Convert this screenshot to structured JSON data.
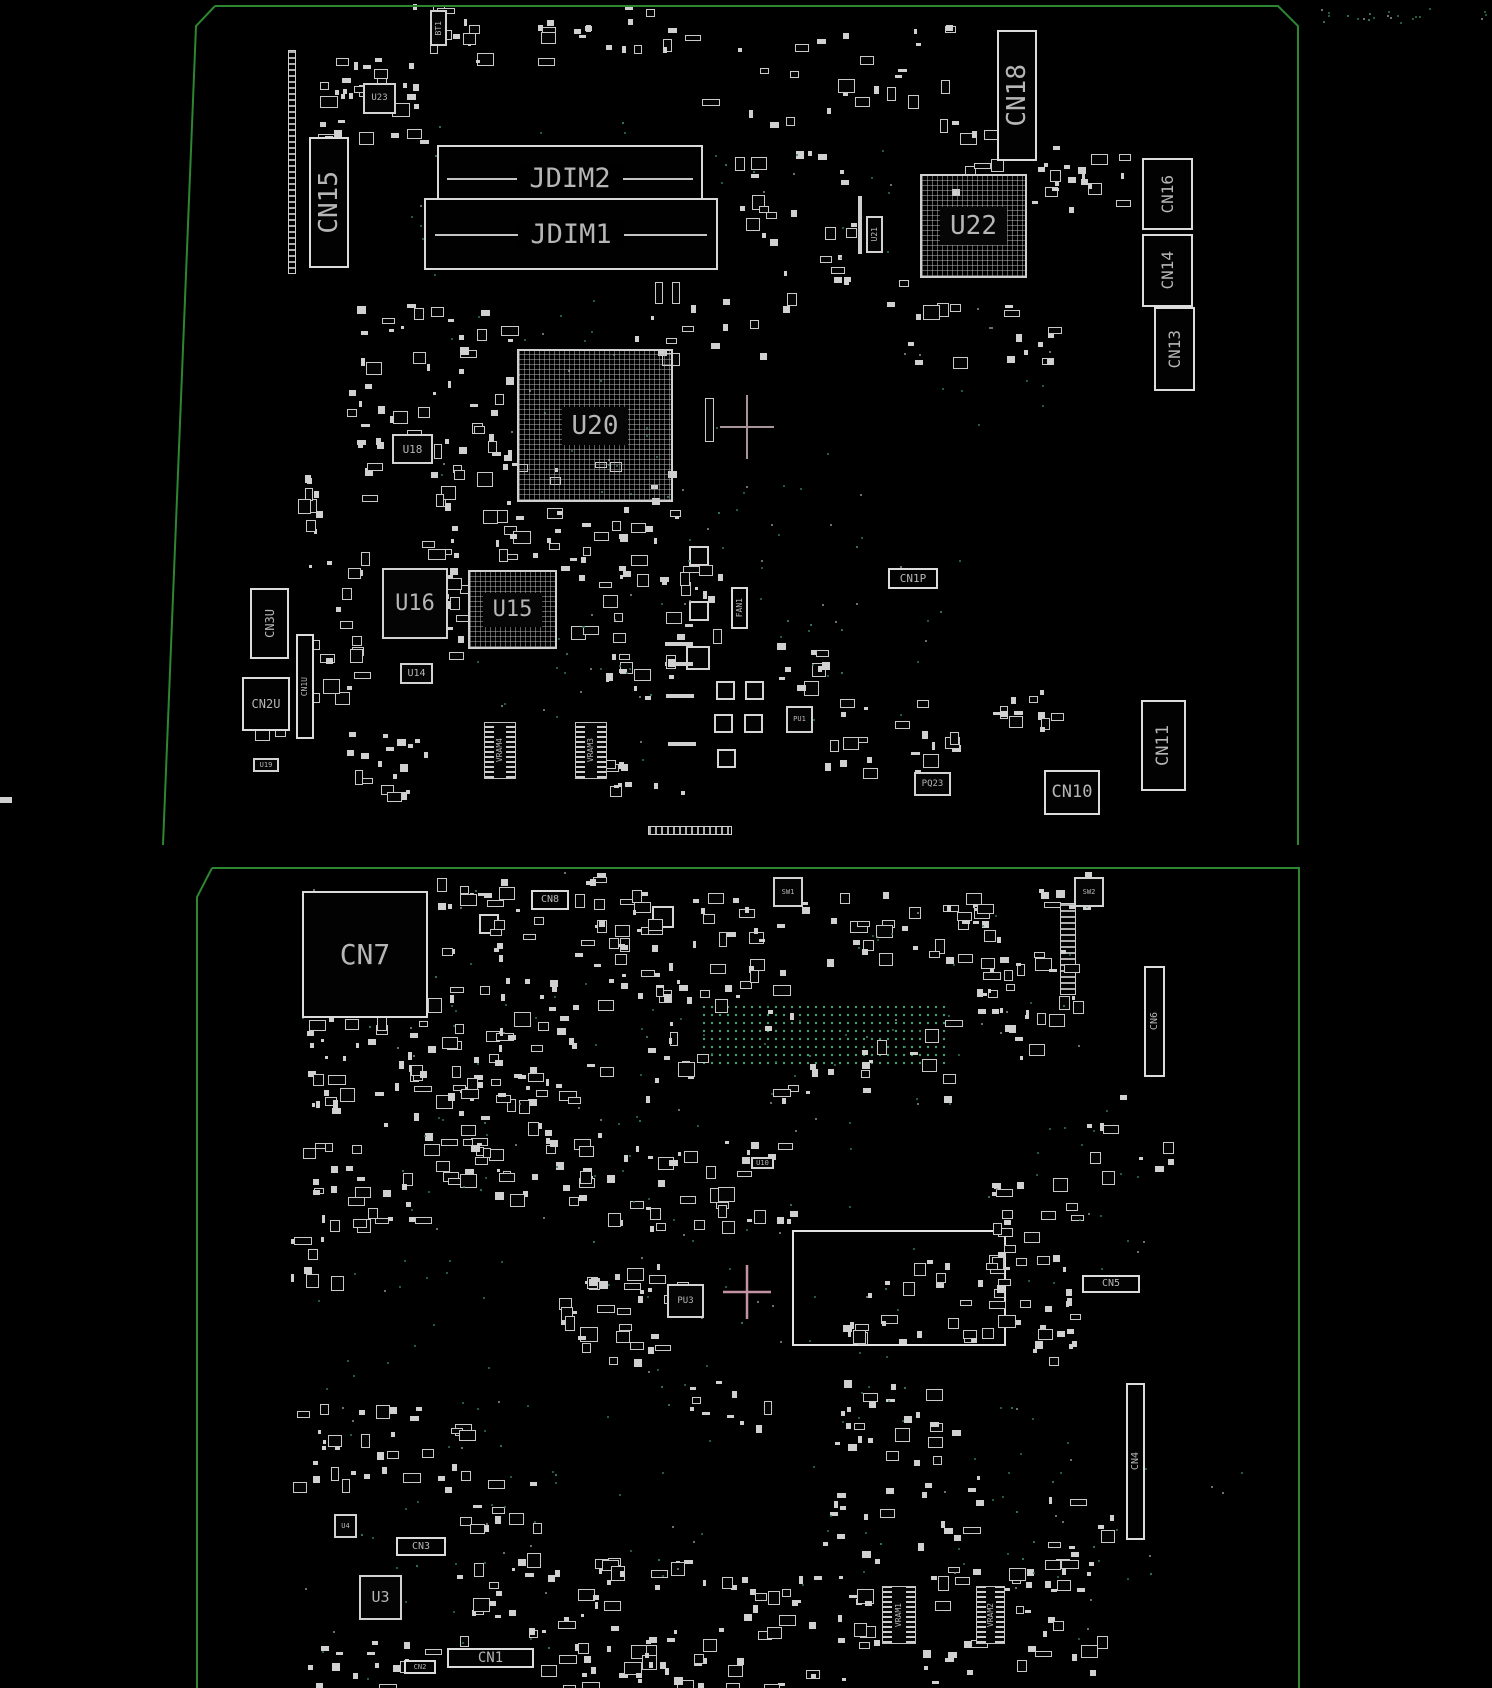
{
  "meta": {
    "description": "PCB boardview silkscreen diagram, two board sides on black background",
    "colors": {
      "background": "#000000",
      "board_outline": "#2d8632",
      "silkscreen": "#d6d6d6",
      "label_text": "#b6b6b6",
      "via_dot_green": "#2f7a50",
      "crosshair_top": "#a89399",
      "crosshair_bottom": "#c493a3"
    }
  },
  "boards": [
    {
      "name": "top-board",
      "outline_path": "M215,6 L1278,6 L1298,26 L1298,845 M215,6 L196,26 L163,845"
    },
    {
      "name": "bottom-board",
      "outline_path": "M212,868 L1299,868 L1299,1688 M212,868 L197,897 L197,1688"
    }
  ],
  "components": [
    {
      "l": "BT1",
      "x": 430,
      "y": 10,
      "w": 17,
      "h": 36,
      "r": 1,
      "f": 8,
      "t": "chip"
    },
    {
      "l": "U23",
      "x": 363,
      "y": 83,
      "w": 33,
      "h": 31,
      "f": 9,
      "t": "chip"
    },
    {
      "l": "CN15",
      "x": 309,
      "y": 137,
      "w": 40,
      "h": 131,
      "r": 1,
      "f": 26,
      "t": "conn"
    },
    {
      "l": "JDIM2",
      "x": 437,
      "y": 145,
      "w": 266,
      "h": 66,
      "f": 27,
      "t": "dimm"
    },
    {
      "l": "JDIM1",
      "x": 424,
      "y": 198,
      "w": 294,
      "h": 72,
      "f": 27,
      "t": "dimm"
    },
    {
      "l": "U22",
      "x": 920,
      "y": 174,
      "w": 107,
      "h": 104,
      "f": 26,
      "t": "bga"
    },
    {
      "l": "U21",
      "x": 866,
      "y": 216,
      "w": 17,
      "h": 37,
      "r": 1,
      "f": 8,
      "t": "chip"
    },
    {
      "l": "CN18",
      "x": 997,
      "y": 30,
      "w": 40,
      "h": 131,
      "r": 1,
      "f": 26,
      "t": "conn"
    },
    {
      "l": "CN16",
      "x": 1142,
      "y": 158,
      "w": 51,
      "h": 72,
      "r": 1,
      "f": 16,
      "t": "conn"
    },
    {
      "l": "CN14",
      "x": 1142,
      "y": 234,
      "w": 51,
      "h": 73,
      "r": 1,
      "f": 16,
      "t": "conn"
    },
    {
      "l": "CN13",
      "x": 1154,
      "y": 307,
      "w": 41,
      "h": 84,
      "r": 1,
      "f": 16,
      "t": "conn"
    },
    {
      "l": "U20",
      "x": 517,
      "y": 349,
      "w": 156,
      "h": 153,
      "f": 26,
      "t": "bga"
    },
    {
      "l": "U18",
      "x": 392,
      "y": 434,
      "w": 41,
      "h": 30,
      "f": 11,
      "t": "chip"
    },
    {
      "l": "U16",
      "x": 382,
      "y": 568,
      "w": 66,
      "h": 71,
      "f": 22,
      "t": "chip"
    },
    {
      "l": "U15",
      "x": 468,
      "y": 570,
      "w": 89,
      "h": 79,
      "f": 22,
      "t": "bga"
    },
    {
      "l": "U14",
      "x": 400,
      "y": 663,
      "w": 33,
      "h": 21,
      "f": 10,
      "t": "chip"
    },
    {
      "l": "CN3U",
      "x": 250,
      "y": 588,
      "w": 39,
      "h": 71,
      "r": 1,
      "f": 12,
      "t": "conn"
    },
    {
      "l": "CN2U",
      "x": 242,
      "y": 677,
      "w": 48,
      "h": 54,
      "f": 12,
      "t": "conn"
    },
    {
      "l": "CN1U",
      "x": 296,
      "y": 634,
      "w": 18,
      "h": 105,
      "r": 1,
      "f": 8,
      "t": "conn"
    },
    {
      "l": "U19",
      "x": 253,
      "y": 758,
      "w": 26,
      "h": 14,
      "f": 7,
      "t": "chip"
    },
    {
      "l": "FAN1",
      "x": 731,
      "y": 587,
      "w": 17,
      "h": 42,
      "r": 1,
      "f": 8,
      "t": "conn"
    },
    {
      "l": "CN1P",
      "x": 888,
      "y": 568,
      "w": 50,
      "h": 21,
      "f": 11,
      "t": "conn"
    },
    {
      "l": "VRAM4",
      "x": 484,
      "y": 722,
      "w": 32,
      "h": 57,
      "r": 1,
      "f": 8,
      "t": "vram"
    },
    {
      "l": "VRAM3",
      "x": 575,
      "y": 722,
      "w": 32,
      "h": 57,
      "r": 1,
      "f": 8,
      "t": "vram"
    },
    {
      "l": "PU1",
      "x": 786,
      "y": 706,
      "w": 27,
      "h": 27,
      "f": 7,
      "t": "chip"
    },
    {
      "l": "PQ23",
      "x": 914,
      "y": 772,
      "w": 37,
      "h": 24,
      "f": 9,
      "t": "chip"
    },
    {
      "l": "CN10",
      "x": 1044,
      "y": 770,
      "w": 56,
      "h": 45,
      "f": 17,
      "t": "conn"
    },
    {
      "l": "CN11",
      "x": 1141,
      "y": 700,
      "w": 45,
      "h": 91,
      "r": 1,
      "f": 17,
      "t": "conn"
    },
    {
      "l": "CN7",
      "x": 302,
      "y": 891,
      "w": 126,
      "h": 127,
      "f": 28,
      "t": "conn"
    },
    {
      "l": "CN8",
      "x": 531,
      "y": 890,
      "w": 38,
      "h": 20,
      "f": 10,
      "t": "conn"
    },
    {
      "l": "SW1",
      "x": 773,
      "y": 877,
      "w": 30,
      "h": 30,
      "f": 7,
      "t": "chip"
    },
    {
      "l": "SW2",
      "x": 1074,
      "y": 877,
      "w": 30,
      "h": 30,
      "f": 7,
      "t": "chip"
    },
    {
      "l": "CN6",
      "x": 1144,
      "y": 966,
      "w": 21,
      "h": 111,
      "r": 1,
      "f": 10,
      "t": "conn"
    },
    {
      "l": "U10",
      "x": 751,
      "y": 1157,
      "w": 23,
      "h": 12,
      "f": 7,
      "t": "chip"
    },
    {
      "l": "PU3",
      "x": 667,
      "y": 1284,
      "w": 37,
      "h": 34,
      "f": 9,
      "t": "chip"
    },
    {
      "l": "CN5",
      "x": 1082,
      "y": 1275,
      "w": 58,
      "h": 18,
      "f": 10,
      "t": "conn"
    },
    {
      "l": "CN4",
      "x": 1126,
      "y": 1383,
      "w": 19,
      "h": 157,
      "r": 1,
      "f": 10,
      "t": "conn"
    },
    {
      "l": "CN3",
      "x": 396,
      "y": 1537,
      "w": 50,
      "h": 19,
      "f": 10,
      "t": "conn"
    },
    {
      "l": "U4",
      "x": 334,
      "y": 1514,
      "w": 23,
      "h": 24,
      "f": 7,
      "t": "chip"
    },
    {
      "l": "U3",
      "x": 359,
      "y": 1575,
      "w": 43,
      "h": 45,
      "f": 15,
      "t": "chip"
    },
    {
      "l": "CN1",
      "x": 447,
      "y": 1648,
      "w": 87,
      "h": 20,
      "f": 14,
      "t": "conn"
    },
    {
      "l": "CN2",
      "x": 404,
      "y": 1660,
      "w": 32,
      "h": 14,
      "f": 7,
      "t": "conn"
    },
    {
      "l": "VRAM1",
      "x": 882,
      "y": 1586,
      "w": 34,
      "h": 58,
      "r": 1,
      "f": 8,
      "t": "vram"
    },
    {
      "l": "VRAM2",
      "x": 976,
      "y": 1586,
      "w": 29,
      "h": 58,
      "r": 1,
      "f": 8,
      "t": "vram"
    }
  ],
  "parts": [
    {
      "k": "tv",
      "x": 288,
      "y": 50,
      "w": 8,
      "h": 224
    },
    {
      "k": "th",
      "x": 648,
      "y": 826,
      "w": 84,
      "h": 9
    },
    {
      "k": "tv",
      "x": 1060,
      "y": 903,
      "w": 16,
      "h": 92
    },
    {
      "k": "o2",
      "x": 792,
      "y": 1230,
      "w": 214,
      "h": 116
    },
    {
      "k": "sq",
      "x": 689,
      "y": 546,
      "w": 20,
      "h": 20
    },
    {
      "k": "sq",
      "x": 689,
      "y": 601,
      "w": 20,
      "h": 20
    },
    {
      "k": "sq",
      "x": 686,
      "y": 646,
      "w": 24,
      "h": 24
    },
    {
      "k": "sq",
      "x": 716,
      "y": 681,
      "w": 19,
      "h": 19
    },
    {
      "k": "sq",
      "x": 745,
      "y": 681,
      "w": 19,
      "h": 19
    },
    {
      "k": "sq",
      "x": 714,
      "y": 714,
      "w": 19,
      "h": 19
    },
    {
      "k": "sq",
      "x": 744,
      "y": 714,
      "w": 19,
      "h": 19
    },
    {
      "k": "sq",
      "x": 717,
      "y": 749,
      "w": 19,
      "h": 19
    },
    {
      "k": "bar",
      "x": 665,
      "y": 642,
      "w": 28,
      "h": 4
    },
    {
      "k": "bar",
      "x": 665,
      "y": 662,
      "w": 28,
      "h": 4
    },
    {
      "k": "bar",
      "x": 666,
      "y": 694,
      "w": 28,
      "h": 4
    },
    {
      "k": "bar",
      "x": 668,
      "y": 742,
      "w": 28,
      "h": 4
    },
    {
      "k": "bar",
      "x": 0,
      "y": 797,
      "w": 12,
      "h": 6
    },
    {
      "k": "sq",
      "x": 479,
      "y": 914,
      "w": 20,
      "h": 20
    },
    {
      "k": "sq",
      "x": 652,
      "y": 906,
      "w": 22,
      "h": 22
    },
    {
      "k": "dg",
      "x": 700,
      "y": 1003,
      "w": 250,
      "h": 62
    },
    {
      "k": "o",
      "x": 655,
      "y": 282,
      "w": 8,
      "h": 22
    },
    {
      "k": "o",
      "x": 672,
      "y": 282,
      "w": 8,
      "h": 22
    },
    {
      "k": "o",
      "x": 705,
      "y": 398,
      "w": 9,
      "h": 44
    },
    {
      "k": "bar",
      "x": 858,
      "y": 196,
      "w": 4,
      "h": 58
    }
  ],
  "clusters": [
    {
      "x": 392,
      "y": 4,
      "w": 300,
      "h": 56,
      "n": 32,
      "s": 11
    },
    {
      "x": 318,
      "y": 58,
      "w": 104,
      "h": 84,
      "n": 40,
      "s": 12
    },
    {
      "x": 700,
      "y": 22,
      "w": 250,
      "h": 100,
      "n": 26,
      "s": 13
    },
    {
      "x": 1028,
      "y": 140,
      "w": 110,
      "h": 72,
      "n": 20,
      "s": 14
    },
    {
      "x": 732,
      "y": 150,
      "w": 126,
      "h": 130,
      "n": 26,
      "s": 15
    },
    {
      "x": 626,
      "y": 280,
      "w": 166,
      "h": 80,
      "n": 14,
      "s": 16
    },
    {
      "x": 330,
      "y": 300,
      "w": 190,
      "h": 168,
      "n": 55,
      "s": 17
    },
    {
      "x": 420,
      "y": 462,
      "w": 140,
      "h": 100,
      "n": 34,
      "s": 18
    },
    {
      "x": 562,
      "y": 462,
      "w": 136,
      "h": 96,
      "n": 20,
      "s": 19
    },
    {
      "x": 298,
      "y": 470,
      "w": 64,
      "h": 230,
      "n": 30,
      "s": 20
    },
    {
      "x": 440,
      "y": 556,
      "w": 30,
      "h": 104,
      "n": 12,
      "s": 21
    },
    {
      "x": 560,
      "y": 560,
      "w": 160,
      "h": 80,
      "n": 26,
      "s": 22
    },
    {
      "x": 600,
      "y": 640,
      "w": 80,
      "h": 60,
      "n": 12,
      "s": 23
    },
    {
      "x": 770,
      "y": 640,
      "w": 60,
      "h": 60,
      "n": 10,
      "s": 24
    },
    {
      "x": 820,
      "y": 698,
      "w": 140,
      "h": 72,
      "n": 20,
      "s": 25
    },
    {
      "x": 988,
      "y": 688,
      "w": 84,
      "h": 44,
      "n": 12,
      "s": 26
    },
    {
      "x": 600,
      "y": 756,
      "w": 100,
      "h": 36,
      "n": 10,
      "s": 27
    },
    {
      "x": 336,
      "y": 716,
      "w": 90,
      "h": 76,
      "n": 18,
      "s": 28
    },
    {
      "x": 240,
      "y": 698,
      "w": 62,
      "h": 34,
      "n": 8,
      "s": 29
    },
    {
      "x": 880,
      "y": 280,
      "w": 140,
      "h": 80,
      "n": 12,
      "s": 30
    },
    {
      "x": 990,
      "y": 300,
      "w": 60,
      "h": 60,
      "n": 8,
      "s": 31
    },
    {
      "x": 940,
      "y": 120,
      "w": 80,
      "h": 70,
      "n": 8,
      "s": 32
    },
    {
      "x": 432,
      "y": 868,
      "w": 210,
      "h": 92,
      "n": 40,
      "s": 33
    },
    {
      "x": 590,
      "y": 888,
      "w": 190,
      "h": 112,
      "n": 48,
      "s": 34
    },
    {
      "x": 800,
      "y": 888,
      "w": 200,
      "h": 72,
      "n": 36,
      "s": 35
    },
    {
      "x": 975,
      "y": 945,
      "w": 100,
      "h": 115,
      "n": 32,
      "s": 36
    },
    {
      "x": 300,
      "y": 980,
      "w": 100,
      "h": 120,
      "n": 28,
      "s": 37
    },
    {
      "x": 402,
      "y": 975,
      "w": 200,
      "h": 125,
      "n": 60,
      "s": 38
    },
    {
      "x": 640,
      "y": 978,
      "w": 60,
      "h": 122,
      "n": 16,
      "s": 39
    },
    {
      "x": 756,
      "y": 1008,
      "w": 200,
      "h": 92,
      "n": 22,
      "s": 40
    },
    {
      "x": 300,
      "y": 1098,
      "w": 120,
      "h": 122,
      "n": 32,
      "s": 41
    },
    {
      "x": 420,
      "y": 1078,
      "w": 180,
      "h": 122,
      "n": 55,
      "s": 42
    },
    {
      "x": 600,
      "y": 1140,
      "w": 190,
      "h": 90,
      "n": 36,
      "s": 43
    },
    {
      "x": 556,
      "y": 1248,
      "w": 130,
      "h": 112,
      "n": 36,
      "s": 44
    },
    {
      "x": 978,
      "y": 1178,
      "w": 95,
      "h": 90,
      "n": 24,
      "s": 45
    },
    {
      "x": 988,
      "y": 1288,
      "w": 85,
      "h": 75,
      "n": 20,
      "s": 46
    },
    {
      "x": 292,
      "y": 1398,
      "w": 170,
      "h": 84,
      "n": 32,
      "s": 47
    },
    {
      "x": 432,
      "y": 1478,
      "w": 110,
      "h": 62,
      "n": 12,
      "s": 48
    },
    {
      "x": 452,
      "y": 1548,
      "w": 170,
      "h": 92,
      "n": 34,
      "s": 49
    },
    {
      "x": 618,
      "y": 1558,
      "w": 165,
      "h": 128,
      "n": 44,
      "s": 50
    },
    {
      "x": 780,
      "y": 1558,
      "w": 100,
      "h": 124,
      "n": 20,
      "s": 51
    },
    {
      "x": 915,
      "y": 1558,
      "w": 65,
      "h": 124,
      "n": 16,
      "s": 52
    },
    {
      "x": 1000,
      "y": 1558,
      "w": 105,
      "h": 128,
      "n": 26,
      "s": 53
    },
    {
      "x": 832,
      "y": 1378,
      "w": 120,
      "h": 84,
      "n": 24,
      "s": 54
    },
    {
      "x": 300,
      "y": 1640,
      "w": 140,
      "h": 46,
      "n": 16,
      "s": 55
    },
    {
      "x": 540,
      "y": 1640,
      "w": 170,
      "h": 46,
      "n": 16,
      "s": 56
    },
    {
      "x": 1080,
      "y": 1080,
      "w": 90,
      "h": 100,
      "n": 10,
      "s": 57
    },
    {
      "x": 680,
      "y": 1380,
      "w": 85,
      "h": 60,
      "n": 10,
      "s": 58
    },
    {
      "x": 290,
      "y": 1228,
      "w": 55,
      "h": 62,
      "n": 8,
      "s": 59
    },
    {
      "x": 840,
      "y": 1252,
      "w": 160,
      "h": 88,
      "n": 30,
      "s": 60
    },
    {
      "x": 1028,
      "y": 870,
      "w": 60,
      "h": 40,
      "n": 8,
      "s": 61
    },
    {
      "x": 820,
      "y": 1470,
      "w": 160,
      "h": 90,
      "n": 20,
      "s": 62
    },
    {
      "x": 1040,
      "y": 1490,
      "w": 80,
      "h": 70,
      "n": 10,
      "s": 63
    }
  ],
  "dotfields": [
    {
      "x": 1310,
      "y": 8,
      "w": 180,
      "h": 14,
      "n": 22,
      "s": 71
    },
    {
      "x": 400,
      "y": 120,
      "w": 300,
      "h": 160,
      "n": 25,
      "s": 72
    },
    {
      "x": 620,
      "y": 420,
      "w": 260,
      "h": 200,
      "n": 30,
      "s": 73
    },
    {
      "x": 760,
      "y": 560,
      "w": 200,
      "h": 160,
      "n": 20,
      "s": 74
    },
    {
      "x": 420,
      "y": 300,
      "w": 220,
      "h": 200,
      "n": 25,
      "s": 75
    },
    {
      "x": 700,
      "y": 150,
      "w": 200,
      "h": 120,
      "n": 15,
      "s": 76
    },
    {
      "x": 300,
      "y": 870,
      "w": 300,
      "h": 200,
      "n": 30,
      "s": 77
    },
    {
      "x": 620,
      "y": 1000,
      "w": 340,
      "h": 150,
      "n": 30,
      "s": 78
    },
    {
      "x": 400,
      "y": 1100,
      "w": 300,
      "h": 200,
      "n": 35,
      "s": 79
    },
    {
      "x": 620,
      "y": 1200,
      "w": 300,
      "h": 200,
      "n": 30,
      "s": 80
    },
    {
      "x": 300,
      "y": 1250,
      "w": 200,
      "h": 200,
      "n": 20,
      "s": 81
    },
    {
      "x": 800,
      "y": 1400,
      "w": 300,
      "h": 200,
      "n": 30,
      "s": 82
    },
    {
      "x": 450,
      "y": 1400,
      "w": 300,
      "h": 180,
      "n": 25,
      "s": 83
    },
    {
      "x": 980,
      "y": 1100,
      "w": 180,
      "h": 200,
      "n": 20,
      "s": 84
    },
    {
      "x": 300,
      "y": 1500,
      "w": 250,
      "h": 180,
      "n": 20,
      "s": 85
    },
    {
      "x": 850,
      "y": 900,
      "w": 250,
      "h": 150,
      "n": 20,
      "s": 86
    },
    {
      "x": 1000,
      "y": 1400,
      "w": 250,
      "h": 250,
      "n": 20,
      "s": 87
    },
    {
      "x": 550,
      "y": 600,
      "w": 120,
      "h": 100,
      "n": 12,
      "s": 88
    },
    {
      "x": 850,
      "y": 300,
      "w": 200,
      "h": 150,
      "n": 12,
      "s": 89
    },
    {
      "x": 450,
      "y": 650,
      "w": 200,
      "h": 120,
      "n": 15,
      "s": 90
    }
  ],
  "crosshairs": [
    {
      "x": 747,
      "y": 427,
      "ah": 27,
      "av": 32,
      "c": "#a89399",
      "sw": 2
    },
    {
      "x": 747,
      "y": 1292,
      "ah": 24,
      "av": 27,
      "c": "#c493a3",
      "sw": 2.5
    }
  ]
}
